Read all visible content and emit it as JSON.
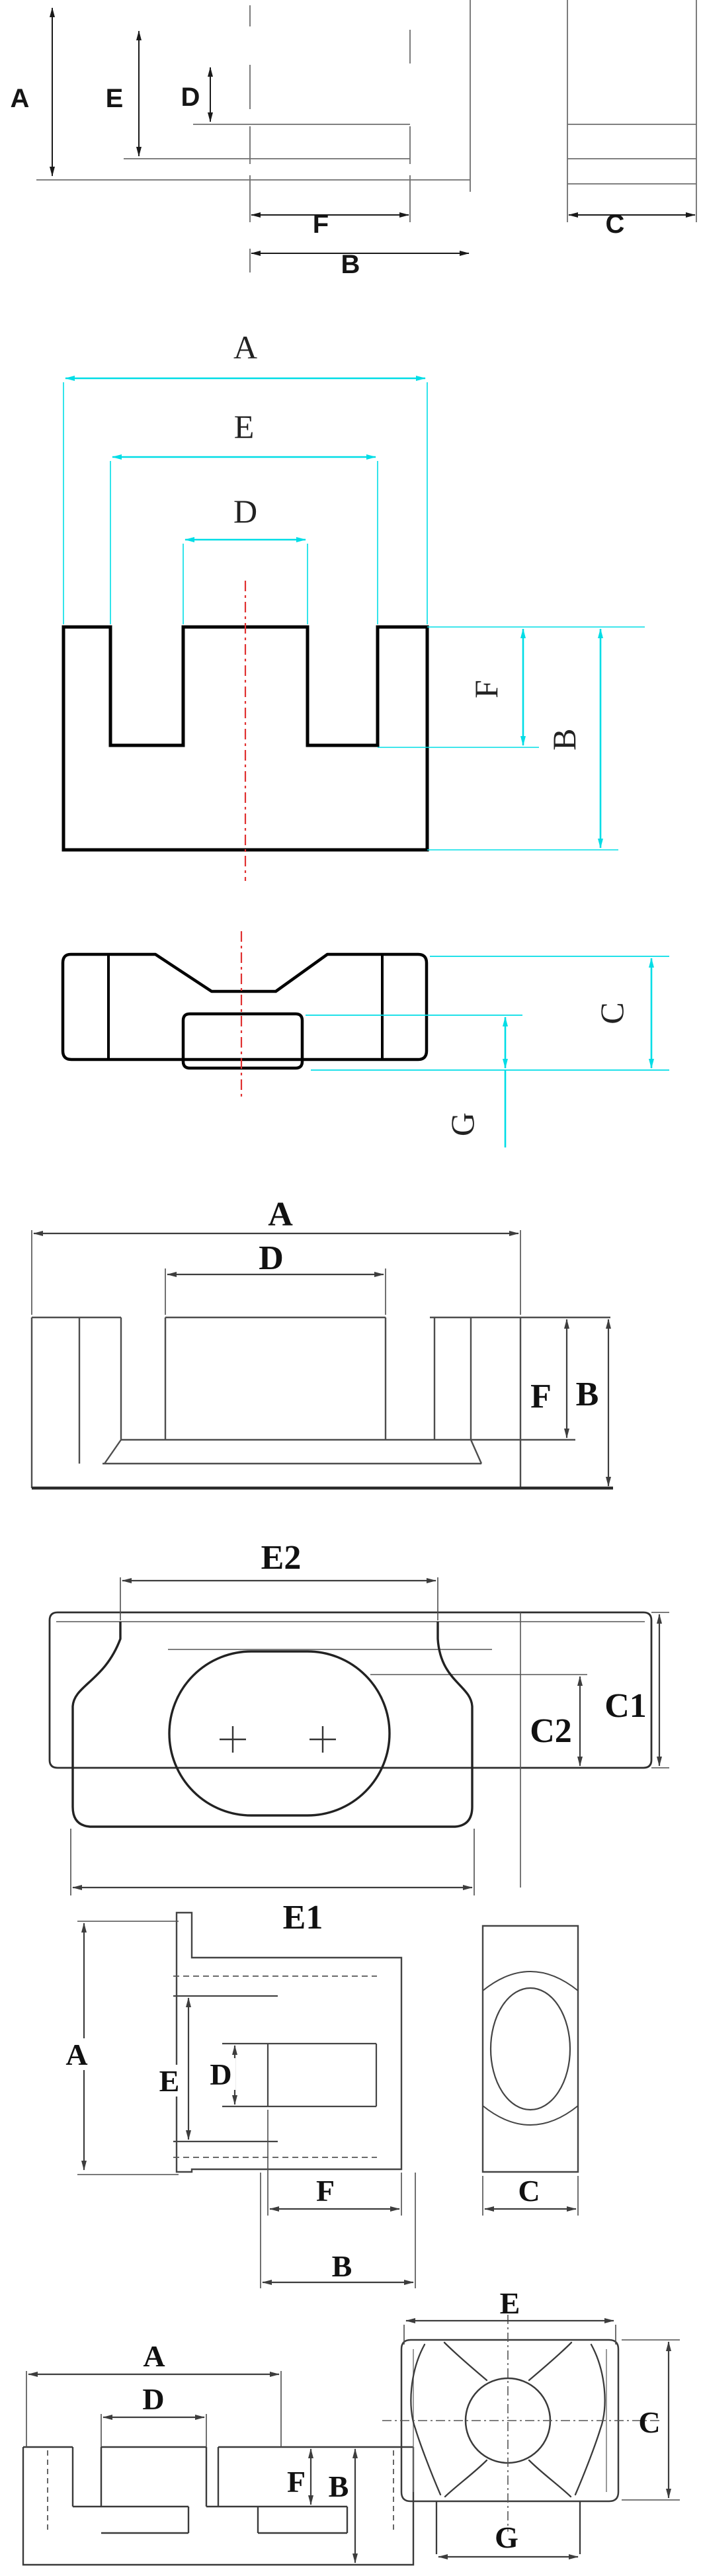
{
  "page": {
    "background": "#ffffff"
  },
  "colors": {
    "part_line_gray": "#6e6e6e",
    "part_line_dark": "#000000",
    "dim_cyan": "#00dde6",
    "centerline_red": "#e03131",
    "label_color": "#111111"
  },
  "drawings": [
    {
      "name": "core-section-side-and-end-view",
      "labels": {
        "A": "A",
        "E": "E",
        "D": "D",
        "F": "F",
        "B": "B",
        "C": "C"
      }
    },
    {
      "name": "ee-core-front-view",
      "labels": {
        "A": "A",
        "E": "E",
        "D": "D",
        "F": "F",
        "B": "B"
      }
    },
    {
      "name": "ee-core-top-view",
      "labels": {
        "C": "C",
        "G": "G"
      }
    },
    {
      "name": "pot-core-front-view",
      "labels": {
        "A": "A",
        "D": "D",
        "F": "F",
        "B": "B"
      }
    },
    {
      "name": "pot-core-top-view",
      "labels": {
        "E2": "E2",
        "E1": "E1",
        "C1": "C1",
        "C2": "C2"
      }
    },
    {
      "name": "er-core-side-and-end-view",
      "labels": {
        "A": "A",
        "E": "E",
        "D": "D",
        "F": "F",
        "B": "B",
        "C": "C"
      }
    },
    {
      "name": "rm-core-front-and-bottom-view",
      "labels": {
        "A": "A",
        "D": "D",
        "F": "F",
        "B": "B",
        "E": "E",
        "C": "C",
        "G": "G"
      }
    }
  ]
}
